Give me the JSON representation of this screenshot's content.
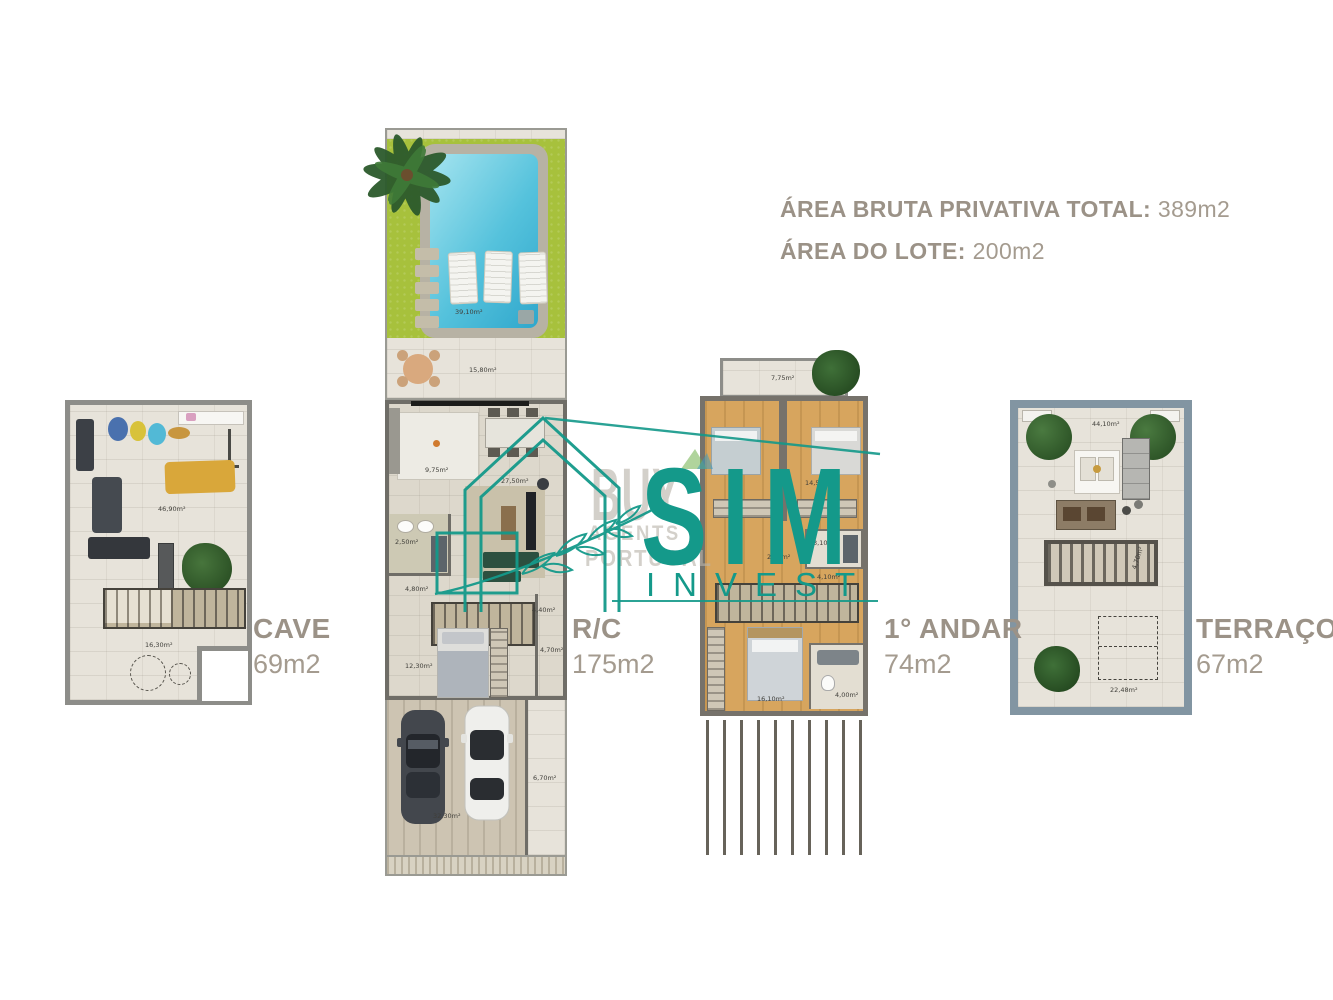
{
  "header": {
    "line1_label": "ÁREA BRUTA PRIVATIVA TOTAL:",
    "line1_value": "389m2",
    "line2_label": "ÁREA DO LOTE:",
    "line2_value": "200m2"
  },
  "plans": {
    "cave": {
      "name": "CAVE",
      "area": "69m2",
      "rooms": {
        "main": "46,90m²",
        "lower": "16,30m²"
      }
    },
    "rc": {
      "name": "R/C",
      "area": "175m2",
      "rooms": {
        "garden": "39,10m²",
        "patio": "15,80m²",
        "kitchen": "9,75m²",
        "living": "27,50m²",
        "wc": "2,50m²",
        "hall": "4,80m²",
        "stairs": "4,40m²",
        "bedroom": "12,30m²",
        "side": "4,70m²",
        "garage": "32,30m²",
        "path": "6,70m²"
      }
    },
    "andar": {
      "name": "1° ANDAR",
      "area": "74m2",
      "rooms": {
        "balcony": "7,75m²",
        "bedroom2": "14,50m²",
        "wc1": "3,10m²",
        "hall": "2,40m²",
        "stairs": "4,10m²",
        "master": "16,10m²",
        "wc2": "4,00m²"
      }
    },
    "terraco": {
      "name": "TERRAÇO",
      "area": "67m2",
      "rooms": {
        "deck": "44,10m²",
        "skylight": "4,70m²",
        "open": "22,48m²"
      }
    }
  },
  "watermarks": {
    "sim_invest": {
      "line1": "SIM",
      "line2": "INVEST",
      "color": "#14998a"
    },
    "buy_agents": {
      "line1": "BUY",
      "line2": "AGENTS",
      "line3": "PORTUGAL",
      "color": "#b9b4aa"
    }
  },
  "colors": {
    "accent_teal": "#14998a",
    "text_taupe": "#9b9287"
  }
}
